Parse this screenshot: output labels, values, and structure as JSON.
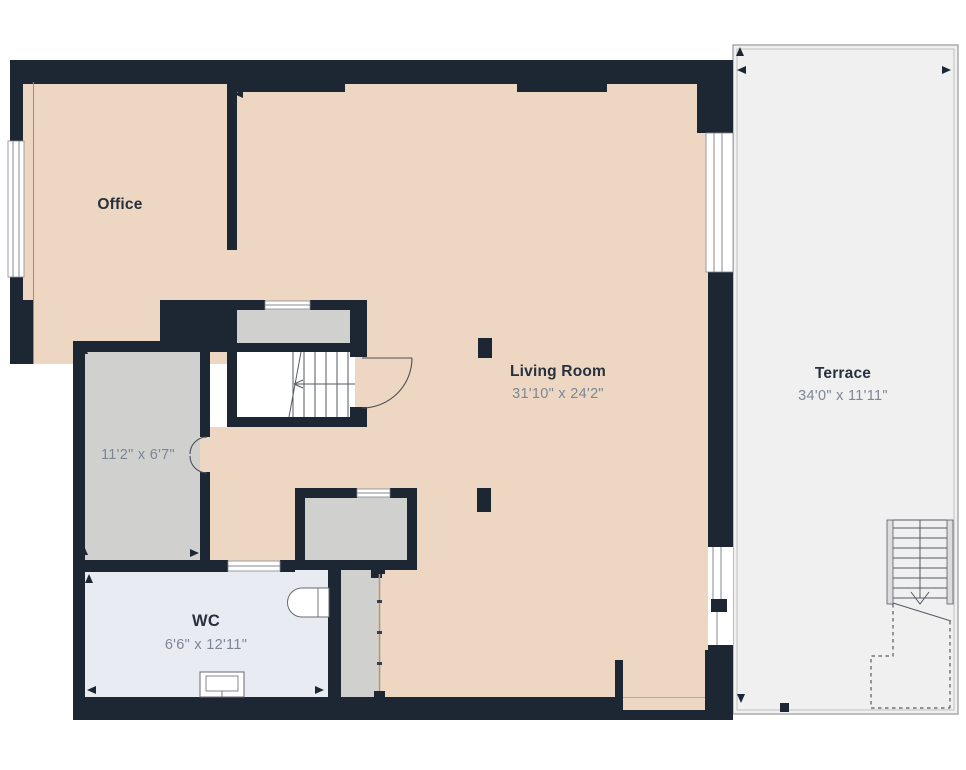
{
  "title": "Floor plan",
  "rooms": {
    "office": {
      "name": "Office"
    },
    "living_room": {
      "name": "Living Room",
      "dims": "31'10\" x 24'2\""
    },
    "terrace": {
      "name": "Terrace",
      "dims": "34'0\" x 11'11\""
    },
    "hallway": {
      "dims": "11'2\" x 6'7\""
    },
    "wc": {
      "name": "WC",
      "dims": "6'6\" x 12'11\""
    }
  },
  "colors": {
    "wall": "#1d2734",
    "floor_main": "#edd7c3",
    "floor_gray": "#d0d0cf",
    "floor_wc": "#e9ebf3",
    "terrace": "#f0f0f1",
    "outline": "#a6a6a8",
    "label": "#27303d",
    "dim_text": "#7d8694"
  }
}
